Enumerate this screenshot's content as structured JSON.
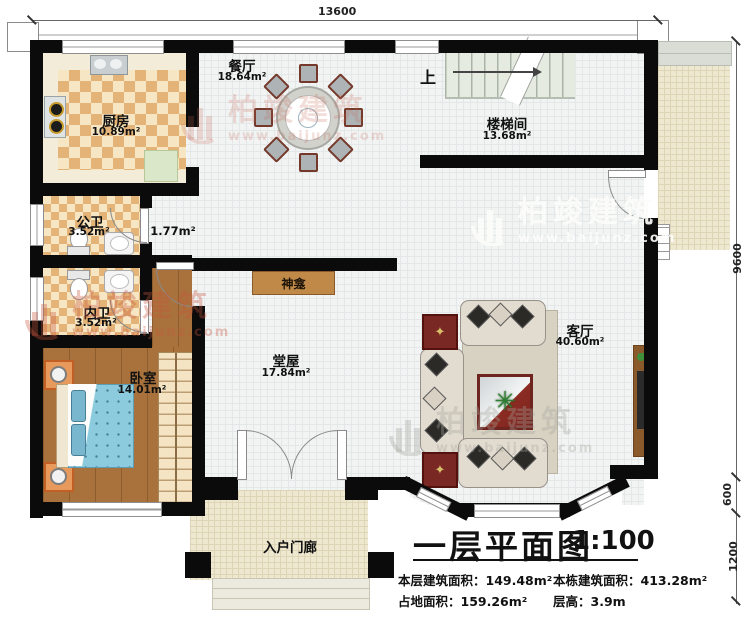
{
  "brand": {
    "name": "柏竣建筑",
    "url": "www.baijunz.com"
  },
  "dimensions": {
    "top_width": "13600",
    "right_height": "9600",
    "right_porch": "600",
    "right_steps": "1200"
  },
  "rooms": {
    "kitchen": {
      "name": "厨房",
      "area": "10.89m²"
    },
    "dining": {
      "name": "餐厅",
      "area": "18.64m²"
    },
    "stairwell": {
      "name": "楼梯间",
      "area": "13.68m²",
      "up_label": "上"
    },
    "bath_public": {
      "name": "公卫",
      "area": "3.52m²"
    },
    "passage": {
      "area": "1.77m²"
    },
    "bath_private": {
      "name": "内卫",
      "area": "3.52m²"
    },
    "bedroom": {
      "name": "卧室",
      "area": "14.01m²"
    },
    "hall": {
      "name": "堂屋",
      "area": "17.84m²"
    },
    "living": {
      "name": "客厅",
      "area": "40.60m²"
    },
    "shrine": {
      "name": "神龛"
    },
    "entry_porch": {
      "name": "入户门廊"
    }
  },
  "title_block": {
    "title": "一层平面图",
    "scale": "1:100",
    "stats": [
      {
        "label": "本层建筑面积：",
        "value": "149.48m²"
      },
      {
        "label": "本栋建筑面积：",
        "value": "413.28m²"
      },
      {
        "label": "占地面积：",
        "value": "159.26m²"
      },
      {
        "label": "层高：",
        "value": "3.9m"
      }
    ]
  },
  "palette": {
    "wall": "#0b0b0b",
    "checker": "#e4b377",
    "wood": "#a9723c",
    "bed_blue": "#8ccade",
    "accent_red": "#7a2824",
    "shrine_brown": "#c08947",
    "watermark_red": "#c8553e"
  }
}
